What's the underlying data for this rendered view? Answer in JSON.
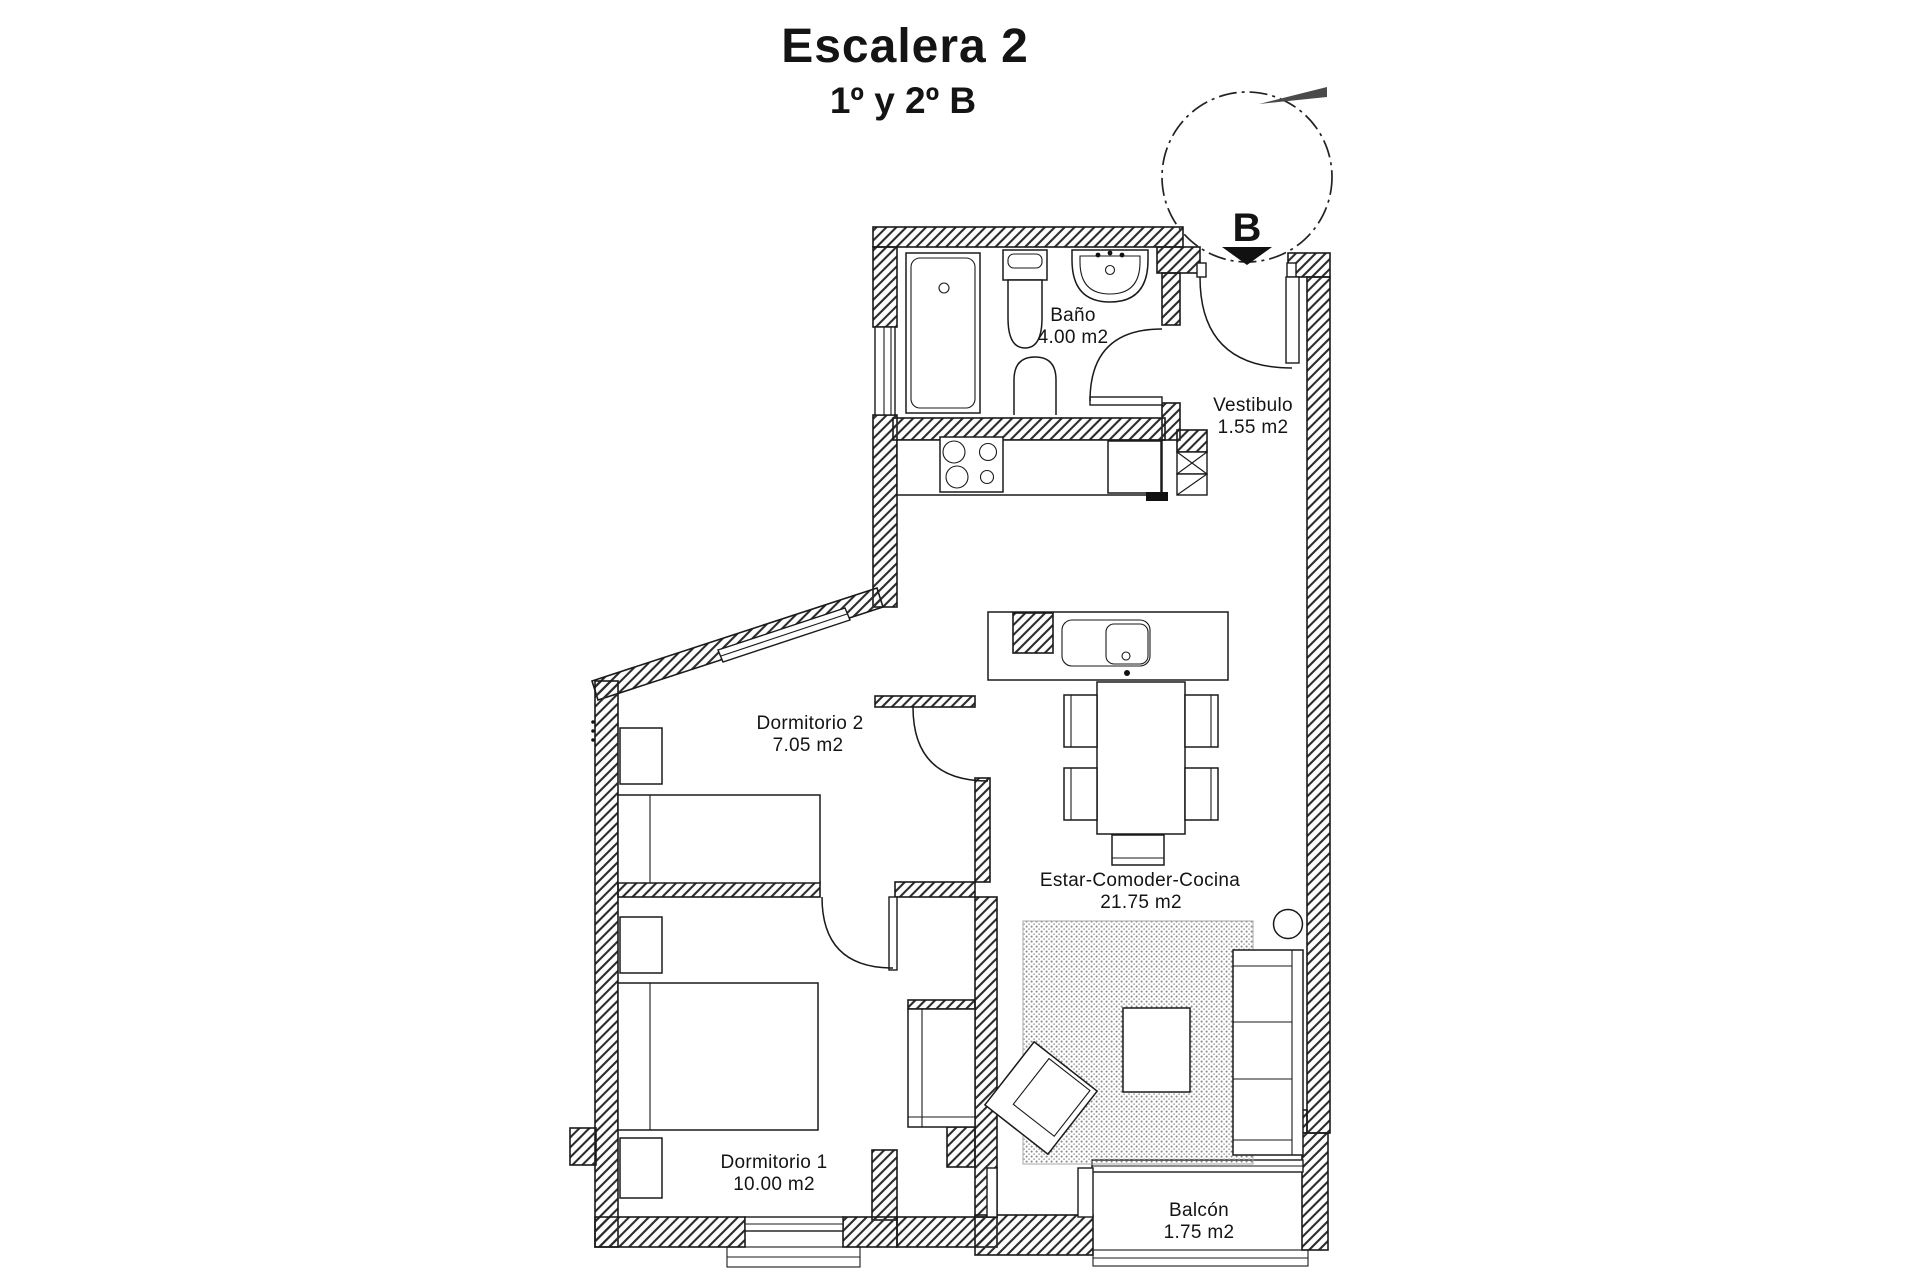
{
  "title": "Escalera 2",
  "subtitle": "1º y 2º B",
  "stair_label": "B",
  "rooms": [
    {
      "name": "Baño",
      "area": "4.00 m2"
    },
    {
      "name": "Vestibulo",
      "area": "1.55 m2"
    },
    {
      "name": "Dormitorio 2",
      "area": "7.05 m2"
    },
    {
      "name": "Estar-Comoder-Cocina",
      "area": "21.75 m2"
    },
    {
      "name": "Dormitorio 1",
      "area": "10.00 m2"
    },
    {
      "name": "Balcón",
      "area": "1.75 m2"
    }
  ],
  "colors": {
    "line": "#1a1a1a",
    "hatch": "#2b2b2b",
    "rug_dot": "#8c8c8c",
    "background": "#ffffff"
  }
}
